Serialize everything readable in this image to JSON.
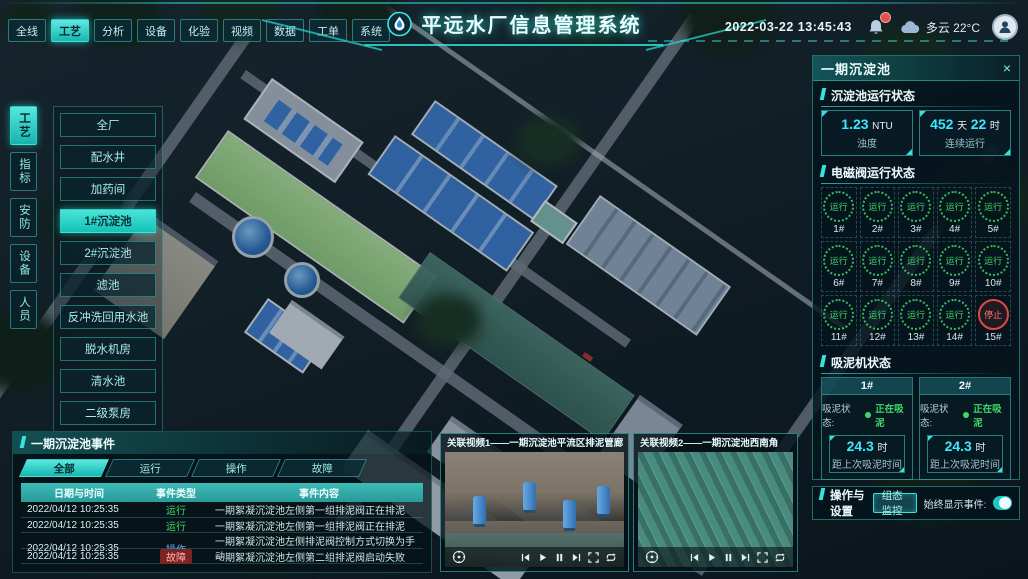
{
  "header": {
    "title": "平远水厂信息管理系统",
    "nav": [
      "全线",
      "工艺",
      "分析",
      "设备",
      "化验",
      "视频",
      "数据",
      "工单",
      "系统"
    ],
    "datetime": "2022-03-22 13:45:43",
    "weather": "多云 22°C"
  },
  "sidebar": {
    "tabs": [
      "工艺",
      "指标",
      "安防",
      "设备",
      "人员"
    ],
    "active_tab": "工艺",
    "menu": [
      "全厂",
      "配水井",
      "加药间",
      "1#沉淀池",
      "2#沉淀池",
      "滤池",
      "反冲洗回用水池",
      "脱水机房",
      "清水池",
      "二级泵房"
    ],
    "active_menu": "1#沉淀池"
  },
  "right_panel": {
    "title": "一期沉淀池",
    "close_icon": "×",
    "pool_status": {
      "title": "沉淀池运行状态",
      "stat1": {
        "value": "1.23",
        "unit": "NTU",
        "label": "浊度"
      },
      "stat2": {
        "value1": "452",
        "unit1": "天",
        "value2": "22",
        "unit2": "时",
        "label": "连续运行"
      }
    },
    "valves": {
      "title": "电磁阀运行状态",
      "items": [
        {
          "id": "1#",
          "status": "运行"
        },
        {
          "id": "2#",
          "status": "运行"
        },
        {
          "id": "3#",
          "status": "运行"
        },
        {
          "id": "4#",
          "status": "运行"
        },
        {
          "id": "5#",
          "status": "运行"
        },
        {
          "id": "6#",
          "status": "运行"
        },
        {
          "id": "7#",
          "status": "运行"
        },
        {
          "id": "8#",
          "status": "运行"
        },
        {
          "id": "9#",
          "status": "运行"
        },
        {
          "id": "10#",
          "status": "运行"
        },
        {
          "id": "11#",
          "status": "运行"
        },
        {
          "id": "12#",
          "status": "运行"
        },
        {
          "id": "13#",
          "status": "运行"
        },
        {
          "id": "14#",
          "status": "运行"
        },
        {
          "id": "15#",
          "status": "停止"
        }
      ]
    },
    "mud": {
      "title": "吸泥机状态",
      "machines": [
        {
          "id": "1#",
          "status_label": "吸泥状态:",
          "status": "正在吸泥",
          "value": "24.3",
          "unit": "时",
          "label": "距上次吸泥时间"
        },
        {
          "id": "2#",
          "status_label": "吸泥状态:",
          "status": "正在吸泥",
          "value": "24.3",
          "unit": "时",
          "label": "距上次吸泥时间"
        }
      ]
    },
    "ops": {
      "title": "操作与设置",
      "button": "组态监控",
      "toggle_label": "始终显示事件:",
      "toggle_on": true
    }
  },
  "events": {
    "title": "一期沉淀池事件",
    "tabs": [
      "全部",
      "运行",
      "操作",
      "故障"
    ],
    "active_tab": "全部",
    "columns": [
      "日期与时间",
      "事件类型",
      "事件内容"
    ],
    "rows": [
      {
        "time": "2022/04/12 10:25:35",
        "type": "运行",
        "content": "一期絮凝沉淀池左侧第一组排泥阀正在排泥"
      },
      {
        "time": "2022/04/12 10:25:35",
        "type": "运行",
        "content": "一期絮凝沉淀池左侧第一组排泥阀正在排泥"
      },
      {
        "time": "2022/04/12 10:25:35",
        "type": "操作",
        "content": "一期絮凝沉淀池左侧排泥阀控制方式切换为手动"
      },
      {
        "time": "2022/04/12 10:25:35",
        "type": "故障",
        "content": "一期絮凝沉淀池左侧第二组排泥阀启动失败"
      }
    ]
  },
  "videos": [
    {
      "title": "关联视频1——一期沉淀池平流区排泥管廊"
    },
    {
      "title": "关联视频2——一期沉淀池西南角"
    }
  ]
}
